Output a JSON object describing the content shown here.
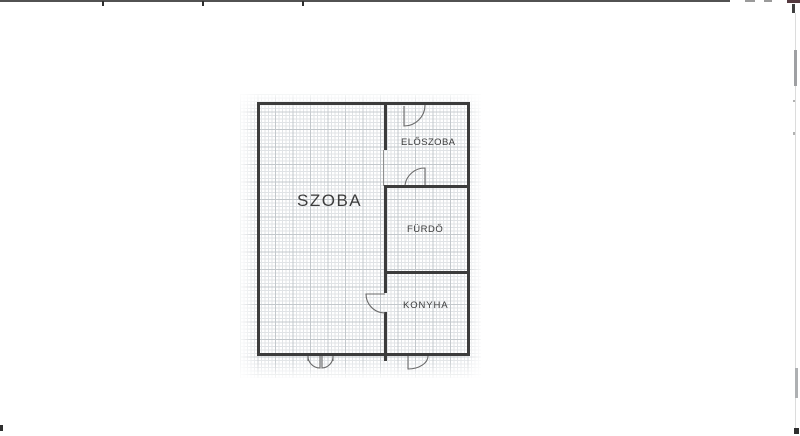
{
  "document": {
    "type": "scanned floor plan",
    "rooms": [
      {
        "id": "szoba",
        "label": "SZOBA"
      },
      {
        "id": "eloszoba",
        "label": "ELŐSZOBA"
      },
      {
        "id": "furdo",
        "label": "FÜRDŐ"
      },
      {
        "id": "konyha",
        "label": "KONYHA"
      }
    ],
    "colors": {
      "background": "#ffffff",
      "wall": "#3c3c3c",
      "grid_minor": "#e0e3e6",
      "grid_major": "#c3c8cc",
      "door_line": "#6a6a6a",
      "label_text": "#3d3d3d"
    }
  }
}
